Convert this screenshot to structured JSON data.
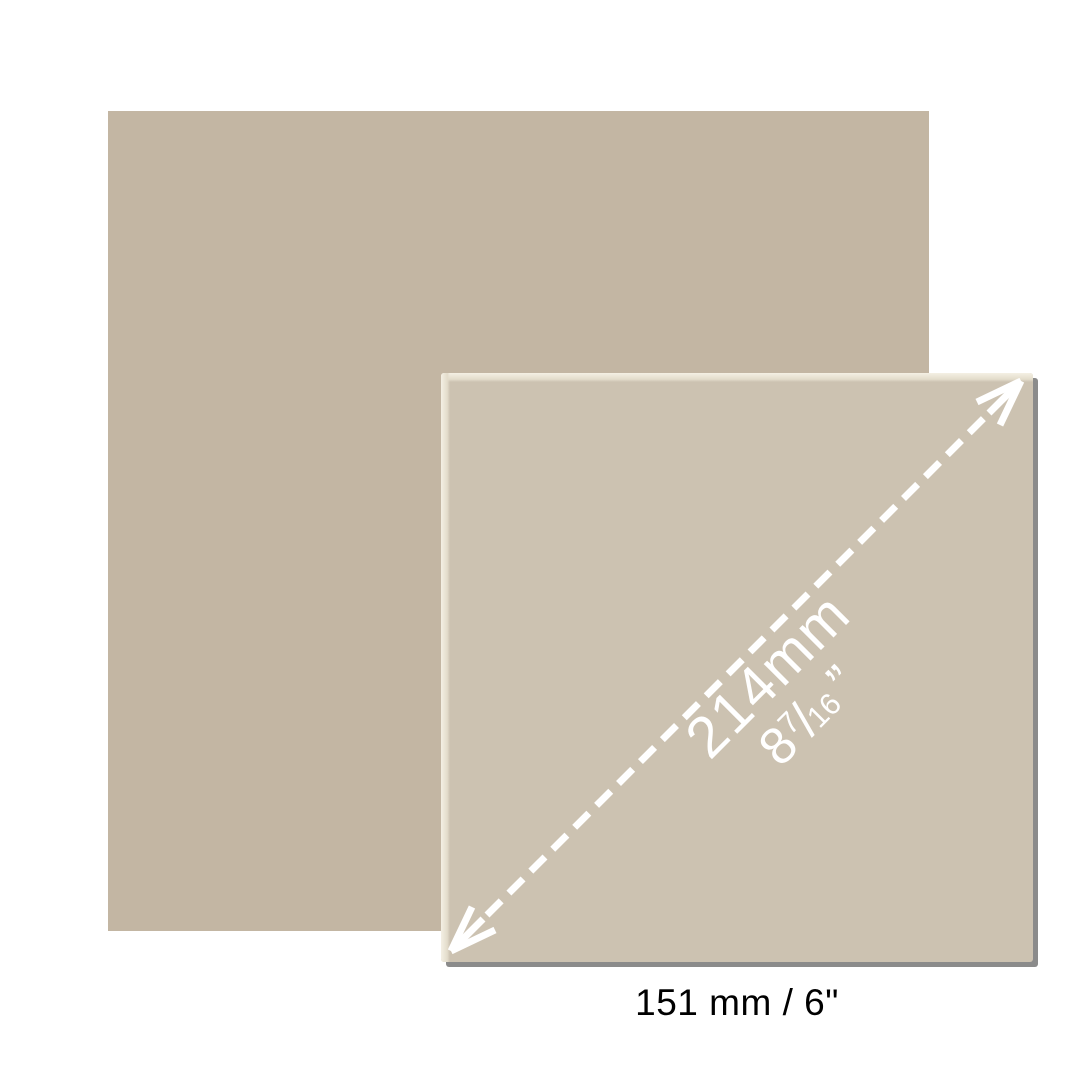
{
  "image": {
    "width_px": 1080,
    "height_px": 1080,
    "background": "#ffffff"
  },
  "colors": {
    "back_swatch": "#c3b6a3",
    "tile_face": "#ccc2b1",
    "tile_bevel_highlight": "#f4f0e4",
    "tile_shadow": "#8b8b8b",
    "dimension_annotation": "#ffffff",
    "caption_text": "#000000"
  },
  "tile": {
    "diagonal_dimension": {
      "mm_label": "214mm",
      "inch_whole": "8",
      "inch_numerator": "7",
      "inch_slash": "/",
      "inch_denominator": "16",
      "inch_quote": "”"
    }
  },
  "caption": {
    "size_label": "151 mm / 6\""
  }
}
